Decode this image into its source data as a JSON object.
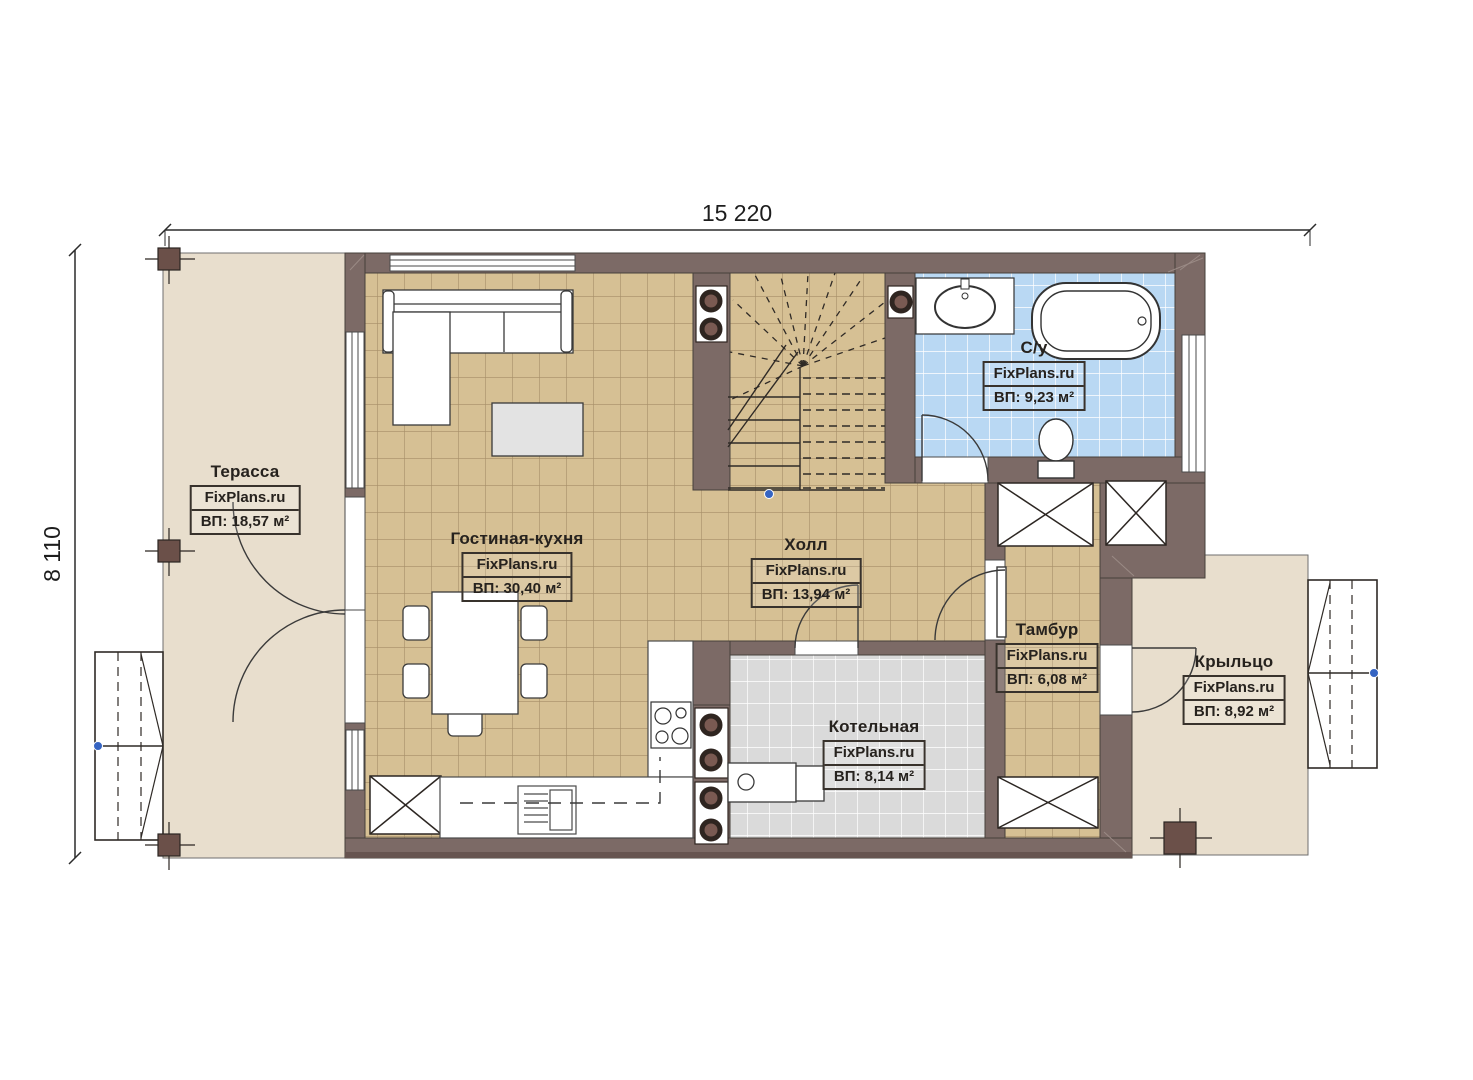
{
  "brand": "FixPlans.ru",
  "dimensions": {
    "width_label": "15 220",
    "height_label": "8 110"
  },
  "rooms": [
    {
      "id": "terrace",
      "name": "Терасса",
      "area": "ВП: 18,57 м²"
    },
    {
      "id": "living-kitchen",
      "name": "Гостиная-кухня",
      "area": "ВП: 30,40 м²"
    },
    {
      "id": "hall",
      "name": "Холл",
      "area": "ВП: 13,94 м²"
    },
    {
      "id": "bathroom",
      "name": "С/у",
      "area": "ВП: 9,23 м²"
    },
    {
      "id": "tambour",
      "name": "Тамбур",
      "area": "ВП: 6,08 м²"
    },
    {
      "id": "boiler",
      "name": "Котельная",
      "area": "ВП: 8,14 м²"
    },
    {
      "id": "porch",
      "name": "Крыльцо",
      "area": "ВП: 8,92 м²"
    }
  ],
  "colors": {
    "wall": "#7c6a66",
    "floor_tile_tan": "#d6c094",
    "floor_tile_blue": "#b9d8f3",
    "floor_tile_gray": "#dadada",
    "outdoor": "#e8decd",
    "marker_blue": "#3564c2"
  }
}
